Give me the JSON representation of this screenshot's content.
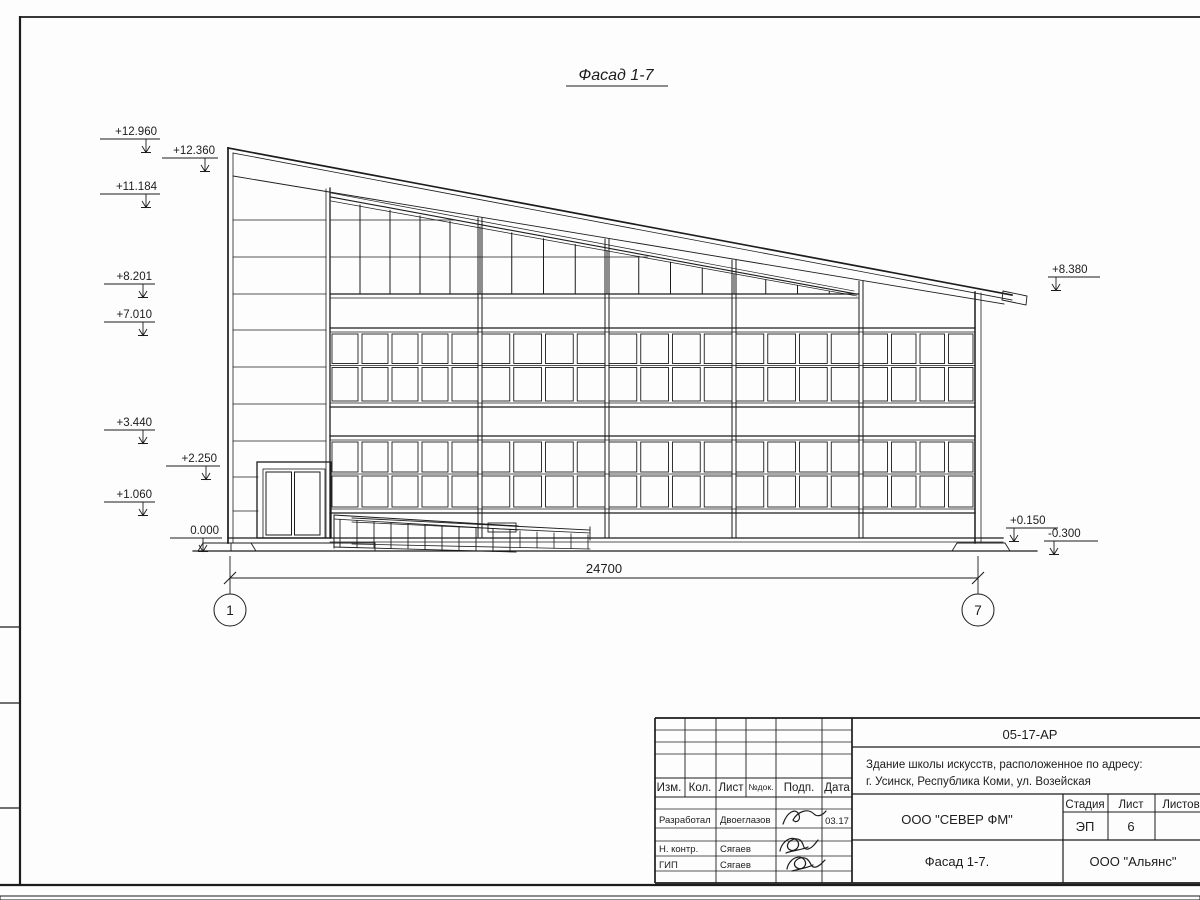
{
  "drawing": {
    "view_title": "Фасад 1-7",
    "marks": {
      "m1": "+12.960",
      "m2": "+12.360",
      "m3": "+11.184",
      "m4": "+8.201",
      "m5": "+7.010",
      "m6": "+3.440",
      "m7": "+2.250",
      "m8": "+1.060",
      "m9": "0.000",
      "m10": "+8.380",
      "m11": "+0.150",
      "m12": "-0.300"
    },
    "dimension": "24700",
    "axis_left": "1",
    "axis_right": "7"
  },
  "title_block": {
    "doc_number": "05-17-АР",
    "project_line1": "Здание школы искусств, расположенное по адресу:",
    "project_line2": "г. Усинск, Республика Коми, ул. Возейская",
    "organization": "ООО \"СЕВЕР ФМ\"",
    "sheet_title": "Фасад 1-7.",
    "company": "ООО \"Альянс\"",
    "stage_header": "Стадия",
    "sheet_header": "Лист",
    "sheets_header": "Листов",
    "stage_value": "ЭП",
    "sheet_value": "6",
    "cols": {
      "izm": "Изм.",
      "kol": "Кол.",
      "list": "Лист",
      "ndok": "№док.",
      "podp": "Подп.",
      "data": "Дата"
    },
    "roles": {
      "developed": "Разработал",
      "ncontrol": "Н. контр.",
      "gip": "ГИП"
    },
    "names": {
      "developed": "Двоеглазов",
      "ncontrol": "Сягаев",
      "gip": "Сягаев"
    },
    "date_developed": "03.17"
  }
}
